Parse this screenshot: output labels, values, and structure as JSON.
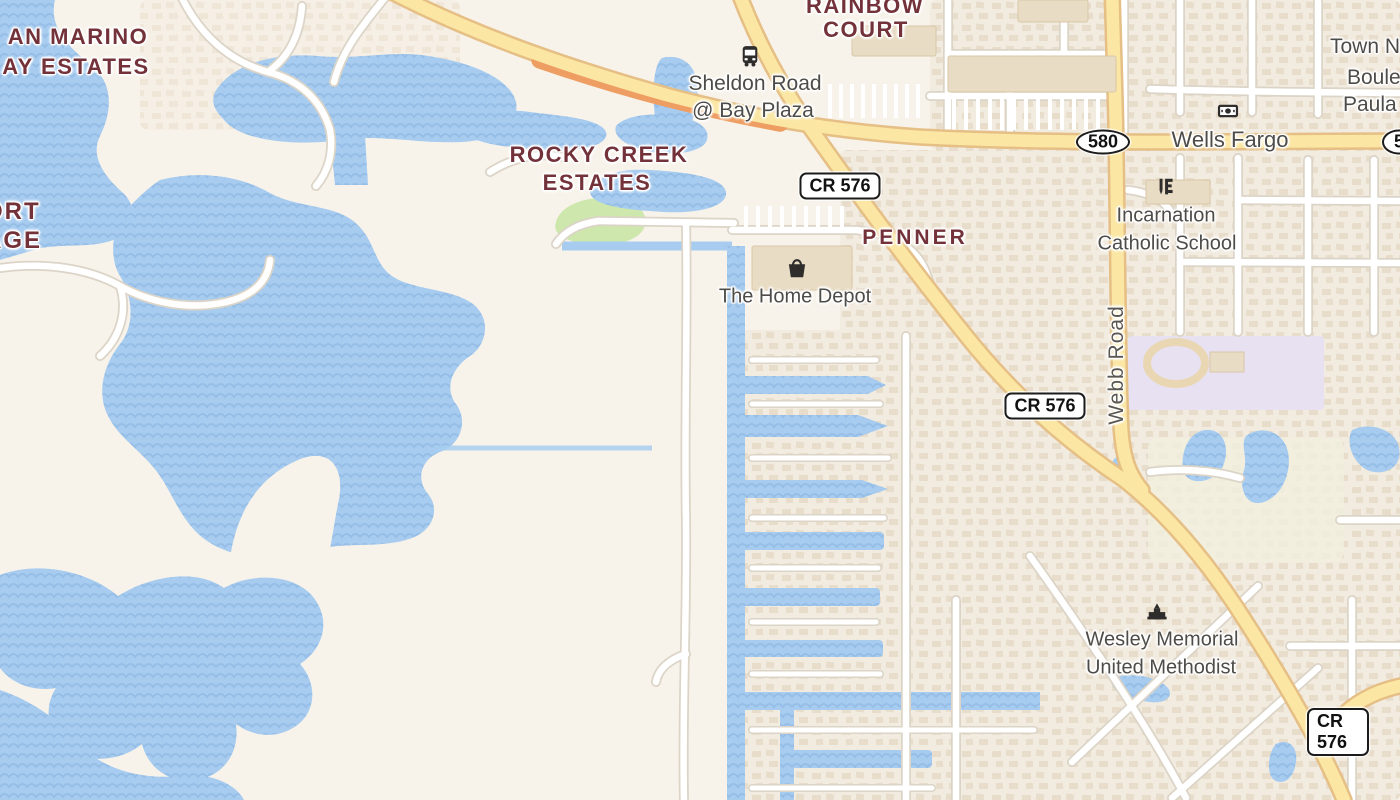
{
  "map": {
    "labels": {
      "san_marino_1": "AN MARINO",
      "san_marino_2": "AY ESTATES",
      "village_1": "ORT",
      "village_2": "AGE",
      "rainbow_1": "RAINBOW",
      "rainbow_2": "COURT",
      "rocky_1": "ROCKY CREEK",
      "rocky_2": "ESTATES",
      "penner": "PENNER",
      "sheldon_1": "Sheldon Road",
      "sheldon_2": "@ Bay Plaza",
      "wells_fargo": "Wells Fargo",
      "incarnation_1": "Incarnation",
      "incarnation_2": "Catholic School",
      "home_depot": "The Home Depot",
      "wesley_1": "Wesley Memorial",
      "wesley_2": "United Methodist",
      "town_n": "Town N",
      "boule": "Boule",
      "paula": "Paula",
      "webb_road": "Webb Road"
    },
    "shields": {
      "cr576": "CR 576",
      "sr580": "580",
      "sr580_partial": "5"
    },
    "icons": {
      "bus_stop": "bus-icon",
      "bank": "money-icon",
      "school": "school-icon",
      "store": "shopping-bag-icon",
      "church": "church-icon"
    },
    "colors": {
      "land": "#f8f3ea",
      "water": "#a7ccf0",
      "water_wave": "#96bee6",
      "residential_bg": "#f2ebe0",
      "house": "#e6d8c4",
      "road_major": "#fbe7a3",
      "road_major_casing": "#e5bf85",
      "road_bridge_casing": "#ee9e63",
      "road_minor": "#ffffff",
      "road_minor_casing": "#dbd4c7",
      "park": "#cde7ad",
      "campus": "#e7e1f2",
      "golf": "#f1f0de",
      "building": "#e9dcc4",
      "building_stroke": "#d9c7a8",
      "label_neighborhood": "#73323a",
      "label_poi": "#4e4c48",
      "icon_dark": "#2e2d2b",
      "shield_border": "#1c1c1c"
    }
  }
}
